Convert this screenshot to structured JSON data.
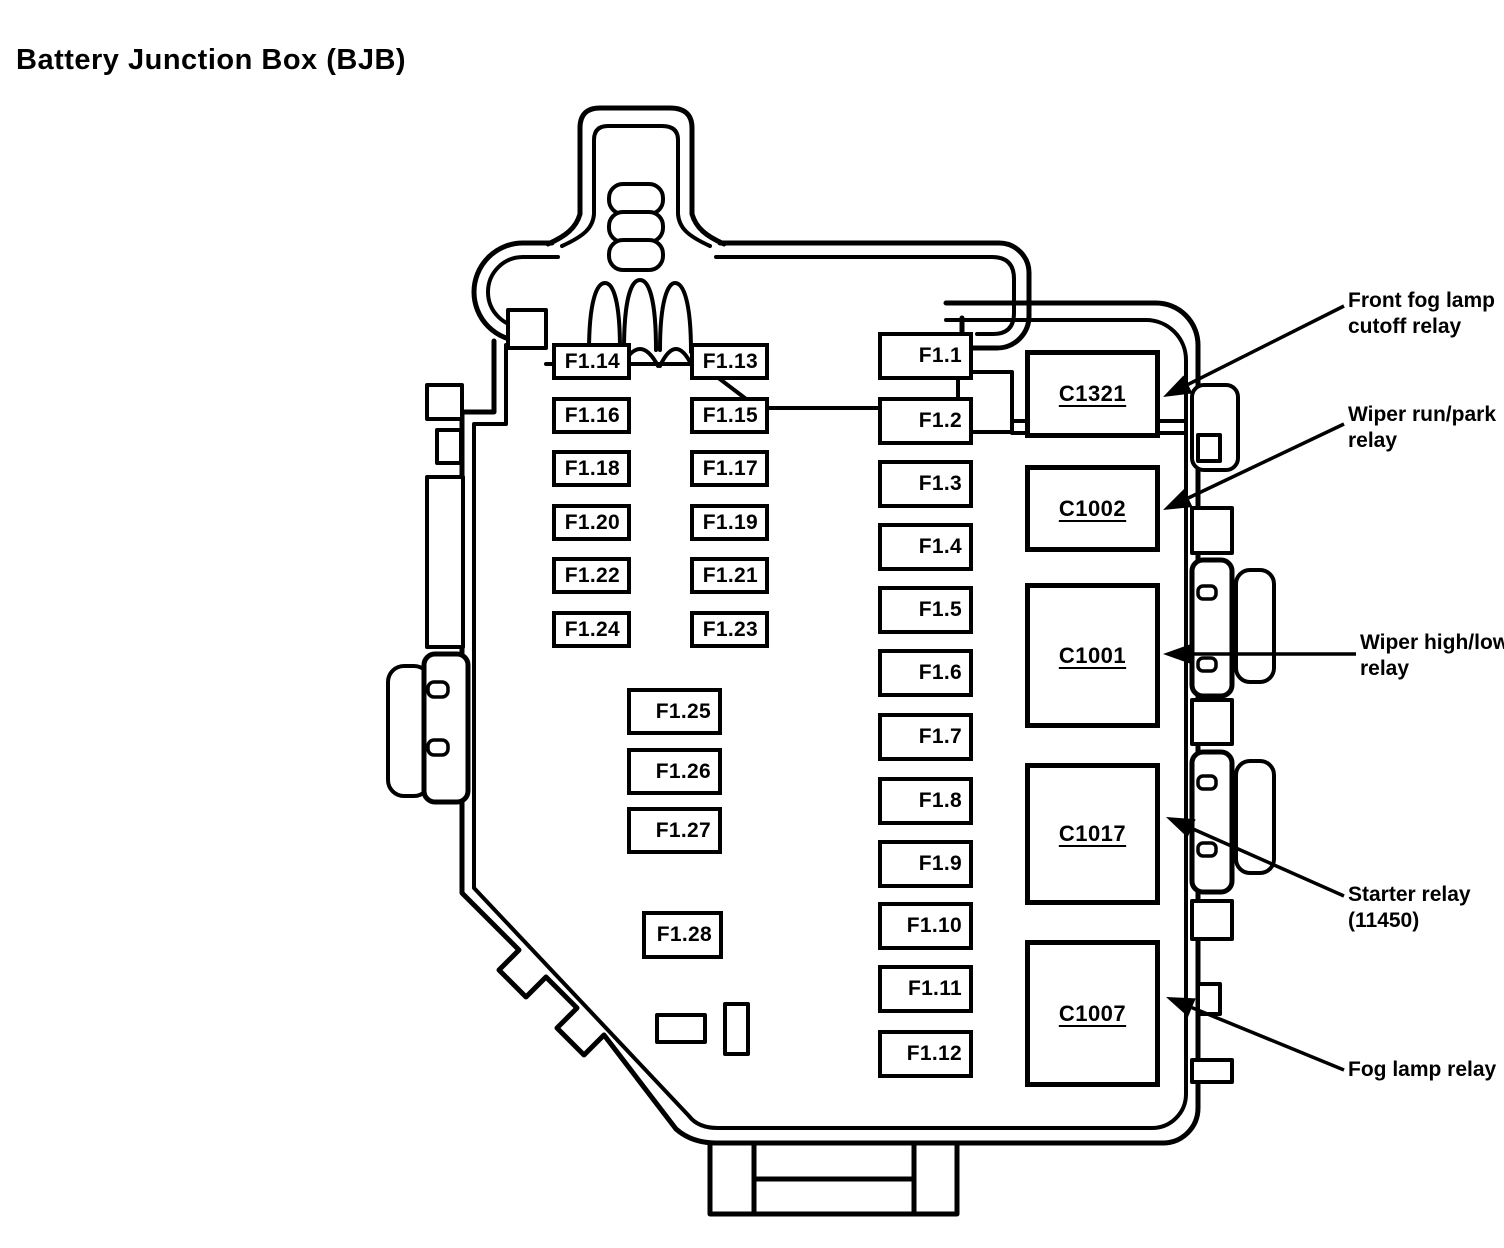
{
  "title": "Battery Junction Box (BJB)",
  "colors": {
    "ink": "#000000",
    "paper": "#ffffff"
  },
  "fuse_grid": {
    "column_a": [
      "F1.14",
      "F1.16",
      "F1.18",
      "F1.20",
      "F1.22",
      "F1.24"
    ],
    "column_b": [
      "F1.13",
      "F1.15",
      "F1.17",
      "F1.19",
      "F1.21",
      "F1.23"
    ],
    "column_mid": [
      "F1.25",
      "F1.26",
      "F1.27"
    ],
    "column_mid_lower": [
      "F1.28"
    ],
    "column_right": [
      "F1.1",
      "F1.2",
      "F1.3",
      "F1.4",
      "F1.5",
      "F1.6",
      "F1.7",
      "F1.8",
      "F1.9",
      "F1.10",
      "F1.11",
      "F1.12"
    ]
  },
  "relays": [
    "C1321",
    "C1002",
    "C1001",
    "C1017",
    "C1007"
  ],
  "callouts": [
    {
      "label": "Front fog lamp\ncutoff relay",
      "target": "C1321"
    },
    {
      "label": "Wiper run/park\nrelay",
      "target": "C1002"
    },
    {
      "label": "Wiper high/low\nrelay",
      "target": "C1001"
    },
    {
      "label": "Starter relay\n(11450)",
      "target": "C1017"
    },
    {
      "label": "Fog lamp relay",
      "target": "C1007"
    }
  ]
}
